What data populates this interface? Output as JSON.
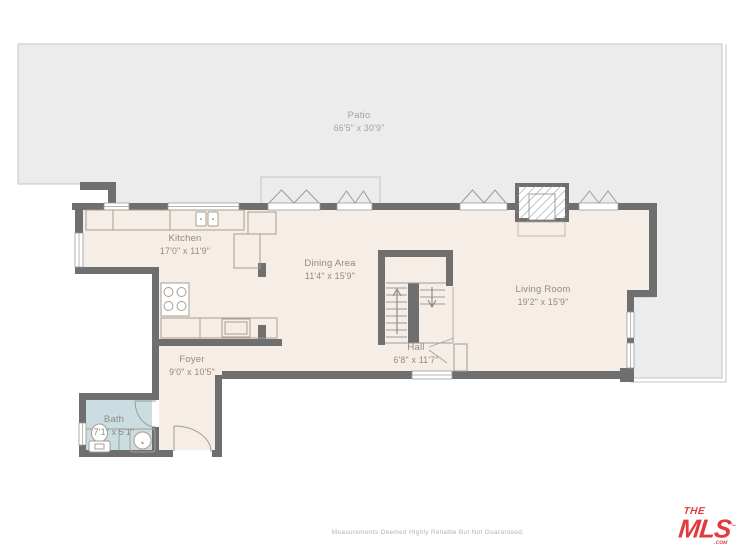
{
  "colors": {
    "wall": "#6f6f6f",
    "floor": "#f6eee6",
    "patio": "#ececec",
    "patio_border": "#c6c6c6",
    "bath": "#cadde0",
    "accent_red": "#e23b3e",
    "label": "#8f8a83",
    "muted_label": "#a2a2a2",
    "disclaimer": "#b4b4b4"
  },
  "rooms": [
    {
      "id": "patio",
      "name": "Patio",
      "dims": "66'5\" x 30'9\""
    },
    {
      "id": "kitchen",
      "name": "Kitchen",
      "dims": "17'0\" x 11'9\""
    },
    {
      "id": "dining",
      "name": "Dining Area",
      "dims": "11'4\" x 15'9\""
    },
    {
      "id": "living",
      "name": "Living Room",
      "dims": "19'2\" x 15'9\""
    },
    {
      "id": "hall",
      "name": "Hall",
      "dims": "6'8\" x 11'7\""
    },
    {
      "id": "foyer",
      "name": "Foyer",
      "dims": "9'0\" x 10'5\""
    },
    {
      "id": "bath",
      "name": "Bath",
      "dims": "7'1\" x 5'1\""
    }
  ],
  "footer": {
    "disclaimer": "Measurements Deemed Highly Reliable But Not Guaranteed."
  },
  "logo": {
    "the": "THE",
    "mls": "MLS",
    "tm": "™",
    "com": ".COM"
  }
}
